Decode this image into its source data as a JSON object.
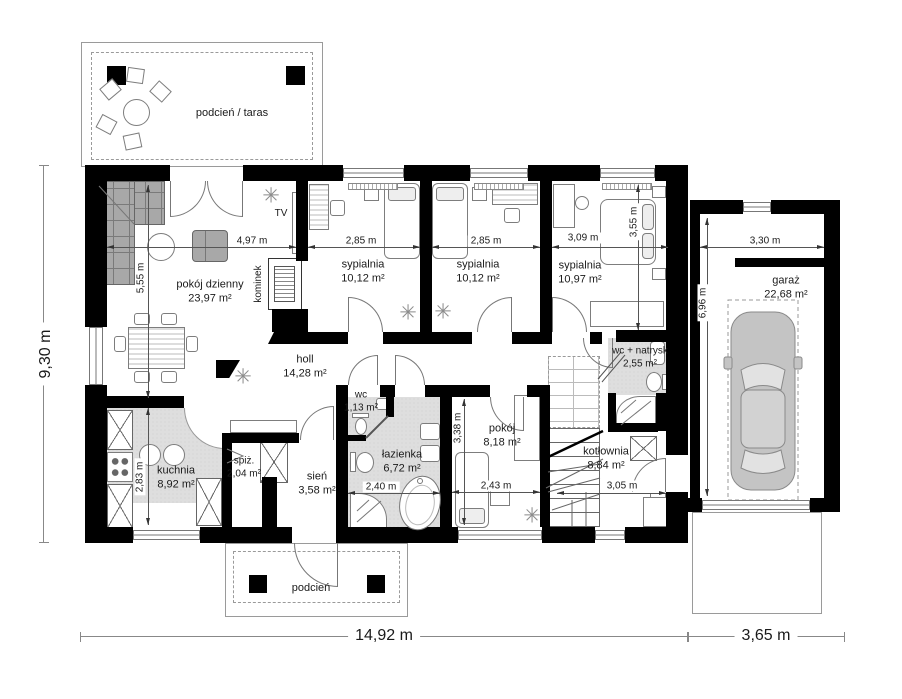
{
  "colors": {
    "wall": "#000000",
    "wet_floor": "#dedede",
    "furniture_line": "#7d7d7d",
    "dimension_line": "#555555",
    "text": "#1a1a1a"
  },
  "icons": {
    "plant": "✳"
  },
  "rooms": {
    "taras": {
      "name": "podcień / taras"
    },
    "dzienny": {
      "name": "pokój dzienny",
      "area": "23,97 m²"
    },
    "syp1": {
      "name": "sypialnia",
      "area": "10,12 m²"
    },
    "syp2": {
      "name": "sypialnia",
      "area": "10,12 m²"
    },
    "syp3": {
      "name": "sypialnia",
      "area": "10,97 m²"
    },
    "garaz": {
      "name": "garaż",
      "area": "22,68 m²"
    },
    "holl": {
      "name": "holl",
      "area": "14,28 m²"
    },
    "wc": {
      "name": "wc",
      "area": "1,13 m²"
    },
    "lazienka": {
      "name": "łazienka",
      "area": "6,72 m²"
    },
    "pokoj": {
      "name": "pokój",
      "area": "8,18 m²"
    },
    "wcnatrysk": {
      "name": "wc + natrysk",
      "area": "2,55 m²"
    },
    "kotlownia": {
      "name": "kotłownia",
      "area": "8,84 m²"
    },
    "kuchnia": {
      "name": "kuchnia",
      "area": "8,92 m²"
    },
    "spiz": {
      "name": "spiż.",
      "area": "2,04 m²"
    },
    "sien": {
      "name": "sień",
      "area": "3,58 m²"
    },
    "podcien": {
      "name": "podcień"
    }
  },
  "labels": {
    "tv": "TV",
    "kominek": "kominek"
  },
  "dims": {
    "total_h": "9,30 m",
    "total_w": "14,92 m",
    "total_garage_w": "3,65 m",
    "living_w": "4,97 m",
    "living_h": "5,55 m",
    "bed1_w": "2,85 m",
    "bed2_w": "2,85 m",
    "bed3_w": "3,09 m",
    "bed3_h": "3,55 m",
    "garage_w": "3,30 m",
    "garage_h": "6,96 m",
    "kitchen_h": "2,83 m",
    "bath_w": "2,40 m",
    "pokoj_w": "2,43 m",
    "pokoj_h": "3,38 m",
    "kotlownia_w": "3,05 m"
  }
}
